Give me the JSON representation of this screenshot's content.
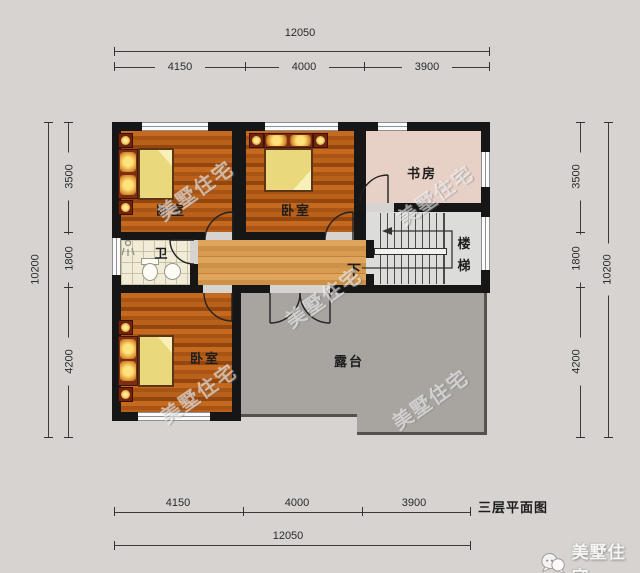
{
  "title": "三层平面图",
  "brand": {
    "watermark": "美墅住宅",
    "logo_text": "美墅住宅"
  },
  "rooms": {
    "bedroom_top_left": "卧室",
    "bedroom_top_mid": "卧室",
    "bedroom_bottom": "卧室",
    "study": "书房",
    "stairs": "楼梯",
    "bathroom": "卫",
    "terrace": "露台",
    "stair_direction": "下"
  },
  "dimensions": {
    "top": {
      "overall": "12050",
      "segments": [
        "4150",
        "4000",
        "3900"
      ]
    },
    "bottom": {
      "overall": "12050",
      "segments": [
        "4150",
        "4000",
        "3900"
      ]
    },
    "left": {
      "overall": "10200",
      "segments": [
        "3500",
        "1800",
        "4200"
      ]
    },
    "right": {
      "overall": "10200",
      "segments": [
        "3500",
        "1800",
        "4200"
      ]
    }
  },
  "colors": {
    "wall": "#161616",
    "wood_floor": "#b55e16",
    "corridor_floor": "#d89a52",
    "study_floor": "#e7d1c7",
    "bath_floor": "#f1ecd8",
    "stair_floor": "#dcdcda",
    "terrace_floor": "#a8a5a1",
    "bed": "#ead97c",
    "bed_frame": "#7c2d12",
    "page_background": "#d6d3d0"
  }
}
